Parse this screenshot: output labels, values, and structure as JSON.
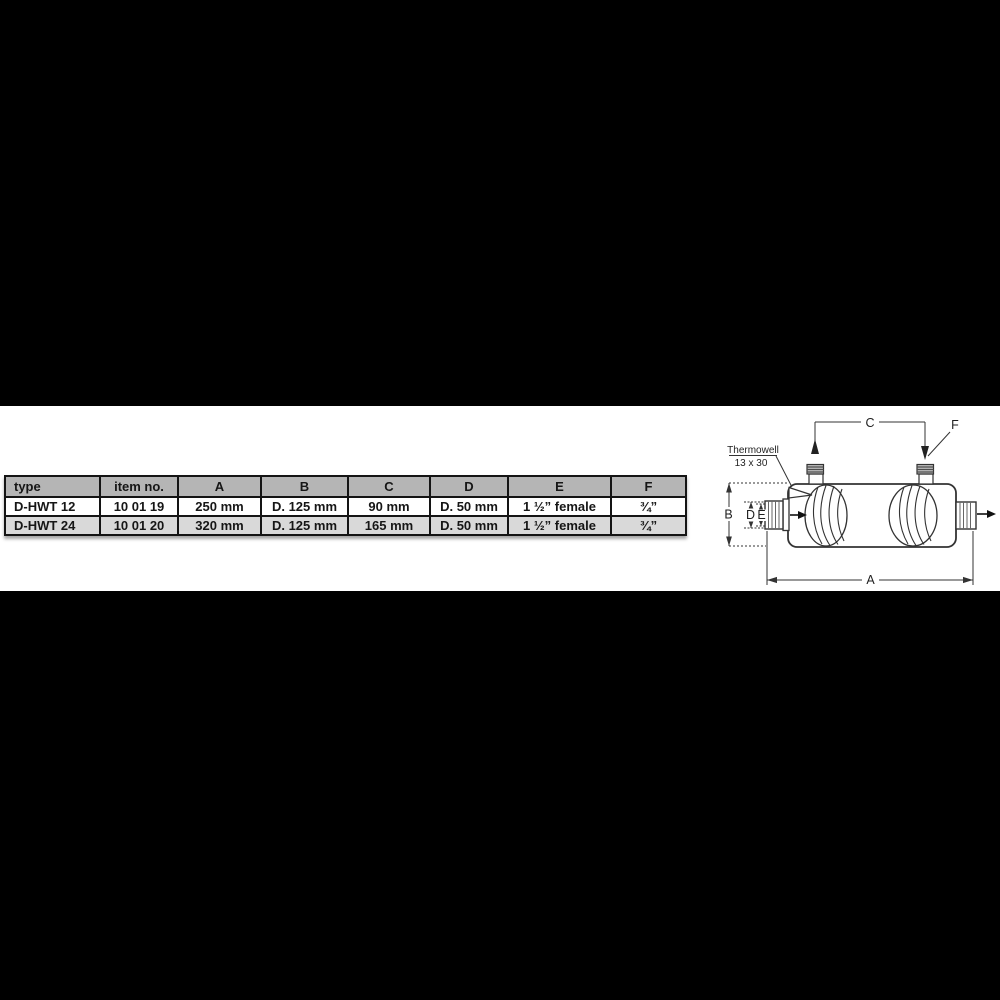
{
  "window": {
    "width": 1000,
    "height": 1000
  },
  "colors": {
    "page_background": "#000000",
    "panel_background": "#ffffff",
    "table_header_bg": "#b5b5b5",
    "table_row_bg": "#ffffff",
    "table_row_alt_bg": "#d9d9d9",
    "table_border": "#141414",
    "drawing_line": "#333333"
  },
  "table": {
    "columns": [
      "type",
      "item no.",
      "A",
      "B",
      "C",
      "D",
      "E",
      "F"
    ],
    "rows": [
      [
        "D-HWT 12",
        "10 01 19",
        "250 mm",
        "D. 125 mm",
        "90 mm",
        "D. 50 mm",
        "1 ½” female",
        "¾”"
      ],
      [
        "D-HWT 24",
        "10 01 20",
        "320 mm",
        "D. 125 mm",
        "165 mm",
        "D. 50 mm",
        "1 ½” female",
        "¾”"
      ]
    ]
  },
  "diagram": {
    "labels": {
      "A": "A",
      "B": "B",
      "C": "C",
      "D": "D",
      "E": "E",
      "F": "F"
    },
    "thermowell": {
      "line1": "Thermowell",
      "line2": "13 x 30"
    }
  }
}
